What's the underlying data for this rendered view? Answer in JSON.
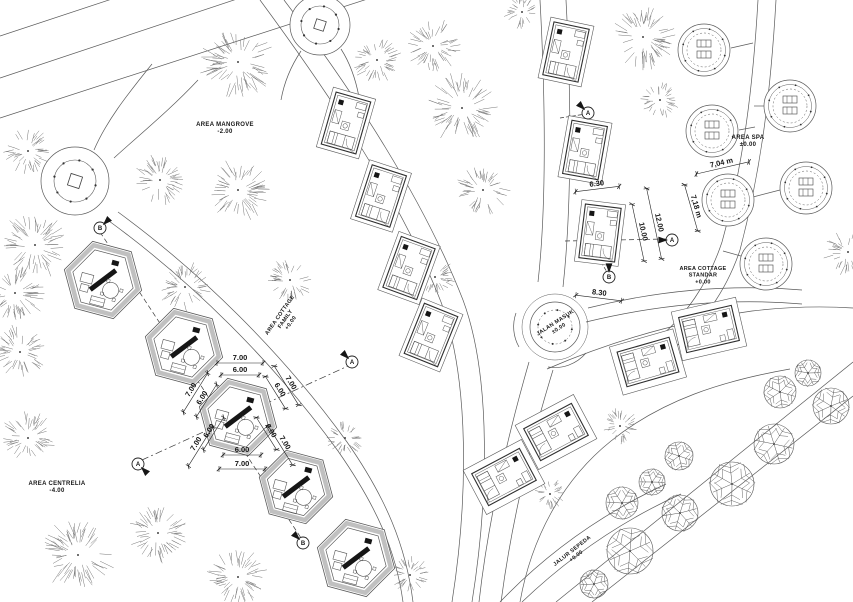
{
  "drawing": {
    "canvas": {
      "w": 853,
      "h": 602
    },
    "colors": {
      "line": "#5a5a5a",
      "line_soft": "#8c8c8c",
      "ink": "#161616",
      "hatch": "#c0c0c0",
      "fill": "#ffffff"
    },
    "labels": [
      {
        "id": "area-mangrove",
        "lines": [
          "AREA MANGROVE",
          "-2.00"
        ],
        "x": 225,
        "y": 126,
        "r": 0,
        "s": 6
      },
      {
        "id": "area-spa",
        "lines": [
          "AREA SPA",
          "±0.00"
        ],
        "x": 748,
        "y": 139,
        "r": 0,
        "s": 6
      },
      {
        "id": "area-cottage-standar",
        "lines": [
          "AREA COTTAGE",
          "STANDAR",
          "+0.00"
        ],
        "x": 703,
        "y": 270,
        "r": 0,
        "s": 5.5
      },
      {
        "id": "area-cottage-family",
        "lines": [
          "AREA COTTAGE",
          "FAMILY",
          "+0.00"
        ],
        "x": 281,
        "y": 316,
        "r": -55,
        "s": 5.5
      },
      {
        "id": "area-centrelia",
        "lines": [
          "AREA CENTRELIA",
          "-4.00"
        ],
        "x": 57,
        "y": 485,
        "r": 0,
        "s": 6
      },
      {
        "id": "jalan-masuk",
        "lines": [
          "JALAN MASUK",
          "±0.00"
        ],
        "x": 556,
        "y": 324,
        "r": -33,
        "s": 5.5
      },
      {
        "id": "jalur-sepeda",
        "lines": [
          "JALUR SEPEDA",
          "+0.00"
        ],
        "x": 573,
        "y": 552,
        "r": -38,
        "s": 5.5
      }
    ],
    "dimensions": [
      {
        "t": "7.00",
        "x": 240,
        "y": 360,
        "r": 0,
        "len": 46
      },
      {
        "t": "6.00",
        "x": 240,
        "y": 372,
        "r": 0,
        "len": 38
      },
      {
        "t": "7.00",
        "x": 193,
        "y": 391,
        "r": -58,
        "len": 46
      },
      {
        "t": "6.00",
        "x": 204,
        "y": 399,
        "r": -58,
        "len": 38
      },
      {
        "t": "7.00",
        "x": 289,
        "y": 384,
        "r": 58,
        "len": 46
      },
      {
        "t": "6.00",
        "x": 278,
        "y": 391,
        "r": 58,
        "len": 38
      },
      {
        "t": "6.00",
        "x": 211,
        "y": 432,
        "r": -58,
        "len": 38
      },
      {
        "t": "7.00",
        "x": 198,
        "y": 445,
        "r": -58,
        "len": 46
      },
      {
        "t": "6.00",
        "x": 269,
        "y": 432,
        "r": 58,
        "len": 38
      },
      {
        "t": "7.00",
        "x": 283,
        "y": 444,
        "r": 58,
        "len": 46
      },
      {
        "t": "6.00",
        "x": 242,
        "y": 452,
        "r": 0,
        "len": 38
      },
      {
        "t": "7.00",
        "x": 242,
        "y": 466,
        "r": 0,
        "len": 46
      },
      {
        "t": "6.30",
        "x": 597,
        "y": 186,
        "r": -7,
        "len": 44
      },
      {
        "t": "10.00",
        "x": 641,
        "y": 232,
        "r": 78,
        "len": 58
      },
      {
        "t": "12.00",
        "x": 657,
        "y": 223,
        "r": 78,
        "len": 72
      },
      {
        "t": "8.30",
        "x": 599,
        "y": 295,
        "r": 7,
        "len": 46
      },
      {
        "t": "7,04 m",
        "x": 722,
        "y": 165,
        "r": -13,
        "len": 54
      },
      {
        "t": "7,18 m",
        "x": 694,
        "y": 207,
        "r": 74,
        "len": 48
      }
    ],
    "markers": [
      {
        "l": "B",
        "x": 100,
        "y": 228,
        "fa": 315
      },
      {
        "l": "A",
        "x": 352,
        "y": 362,
        "fa": 225
      },
      {
        "l": "A",
        "x": 138,
        "y": 464,
        "fa": 45
      },
      {
        "l": "B",
        "x": 303,
        "y": 543,
        "fa": 225
      },
      {
        "l": "A",
        "x": 672,
        "y": 240,
        "fa": 180
      },
      {
        "l": "B",
        "x": 609,
        "y": 277,
        "fa": 270
      },
      {
        "l": "A",
        "x": 588,
        "y": 113,
        "fa": 225
      }
    ],
    "paths": [
      "M0,118 L420,-18",
      "M0,78 L252,-6",
      "M0,36 L118,-3",
      "M152,64 C126,96 106,122 94,150",
      "M198,80 C170,110 138,136 114,158",
      "M118,212 C200,272 282,352 347,442 C386,498 406,546 413,602",
      "M109,221 C191,281 273,361 338,451 C377,507 396,551 403,602",
      "M260,0 C330,95 402,202 441,302 C470,380 468,500 452,602",
      "M284,0 C354,92 424,200 463,300 C492,378 488,502 472,602",
      "M540,0 C546,110 546,212 538,282",
      "M566,0 C572,112 571,214 563,287",
      "M529,362 C506,442 488,522 479,602",
      "M553,370 C529,448 511,526 501,602",
      "M758,0 C753,85 744,162 722,242 C708,284 686,316 654,342",
      "M776,0 C771,87 762,166 740,250 C726,292 702,324 670,352",
      "M731,48 L753,43",
      "M739,130 L755,127",
      "M764,106 L754,106",
      "M780,190 L753,197",
      "M748,258 L723,251",
      "M588,308 C660,290 732,284 802,290",
      "M586,322 C660,304 732,298 802,304",
      "M547,369 C612,341 682,321 752,311 C786,307 822,306 853,308",
      "M520,602 C531,540 561,481 611,441 C662,400 722,381 790,369",
      "M500,602 C546,554 601,514 666,484",
      "M522,602 C566,560 619,522 681,494",
      "M301,51 C291,66 284,83 281,100",
      "M341,49 C350,63 356,81 359,97",
      "M556,602 L853,362",
      "M592,602 L853,396",
      "M586,353 A41,41 0 0 1 548,367",
      "M516,313 A41,41 0 0 0 519,347"
    ],
    "dashes": [
      {
        "d": "M100,232 L303,541",
        "p": "5,3"
      },
      {
        "d": "M142,460 L348,366",
        "p": "7,3,2,3"
      },
      {
        "d": "M565,241 L666,239",
        "p": "5,3"
      },
      {
        "d": "M601,262 L607,272",
        "p": "4,2"
      },
      {
        "d": "M560,118 L586,114",
        "p": "4,2"
      }
    ],
    "plazas": [
      {
        "cx": 75,
        "cy": 181,
        "ro": 34,
        "ri": 21,
        "sq": 12
      },
      {
        "cx": 320,
        "cy": 25,
        "ro": 30,
        "ri": 19,
        "sq": 10
      }
    ],
    "roundabout": {
      "cx": 555,
      "cy": 327,
      "ro": 25,
      "ri": 17,
      "ring": 33
    },
    "hex_cottages": [
      {
        "cx": 103,
        "cy": 280,
        "R": 40,
        "rot": 15
      },
      {
        "cx": 184,
        "cy": 347,
        "R": 40,
        "rot": 15
      },
      {
        "cx": 238,
        "cy": 417,
        "R": 40,
        "rot": 15
      },
      {
        "cx": 296,
        "cy": 487,
        "R": 38,
        "rot": 15
      },
      {
        "cx": 356,
        "cy": 558,
        "R": 40,
        "rot": 15
      }
    ],
    "std_cottages_v": [
      {
        "cx": 346,
        "cy": 123,
        "rot": 16
      },
      {
        "cx": 381,
        "cy": 196,
        "rot": 18
      },
      {
        "cx": 409,
        "cy": 268,
        "rot": 20
      },
      {
        "cx": 431,
        "cy": 335,
        "rot": 22
      },
      {
        "cx": 566,
        "cy": 52,
        "rot": 12
      },
      {
        "cx": 585,
        "cy": 150,
        "rot": 10
      },
      {
        "cx": 600,
        "cy": 233,
        "rot": 7
      }
    ],
    "std_cottages_h": [
      {
        "cx": 504,
        "cy": 477,
        "rot": -28
      },
      {
        "cx": 556,
        "cy": 432,
        "rot": -28
      },
      {
        "cx": 648,
        "cy": 362,
        "rot": -16
      },
      {
        "cx": 709,
        "cy": 329,
        "rot": -13
      }
    ],
    "cabanas": [
      {
        "cx": 704,
        "cy": 50
      },
      {
        "cx": 790,
        "cy": 106
      },
      {
        "cx": 712,
        "cy": 131
      },
      {
        "cx": 728,
        "cy": 200
      },
      {
        "cx": 806,
        "cy": 188
      },
      {
        "cx": 766,
        "cy": 264
      }
    ],
    "trees_bushy": [
      [
        238,
        62,
        30
      ],
      [
        377,
        60,
        20
      ],
      [
        433,
        46,
        22
      ],
      [
        522,
        12,
        14
      ],
      [
        28,
        151,
        19
      ],
      [
        160,
        180,
        21
      ],
      [
        238,
        190,
        26
      ],
      [
        35,
        245,
        27
      ],
      [
        15,
        293,
        24
      ],
      [
        185,
        287,
        20
      ],
      [
        290,
        280,
        18
      ],
      [
        20,
        352,
        22
      ],
      [
        462,
        108,
        28
      ],
      [
        483,
        190,
        21
      ],
      [
        435,
        277,
        16
      ],
      [
        643,
        37,
        26
      ],
      [
        660,
        100,
        15
      ],
      [
        620,
        426,
        15
      ],
      [
        550,
        494,
        13
      ],
      [
        345,
        438,
        15
      ],
      [
        28,
        438,
        22
      ],
      [
        78,
        555,
        29
      ],
      [
        158,
        533,
        24
      ],
      [
        238,
        577,
        24
      ],
      [
        410,
        575,
        16
      ],
      [
        848,
        252,
        19
      ]
    ],
    "trees_branchy": [
      [
        780,
        392,
        16
      ],
      [
        808,
        373,
        13
      ],
      [
        831,
        406,
        18
      ],
      [
        774,
        444,
        20
      ],
      [
        732,
        484,
        22
      ],
      [
        679,
        456,
        14
      ],
      [
        652,
        482,
        13
      ],
      [
        622,
        503,
        16
      ],
      [
        680,
        513,
        18
      ],
      [
        630,
        551,
        23
      ],
      [
        594,
        584,
        14
      ]
    ]
  }
}
